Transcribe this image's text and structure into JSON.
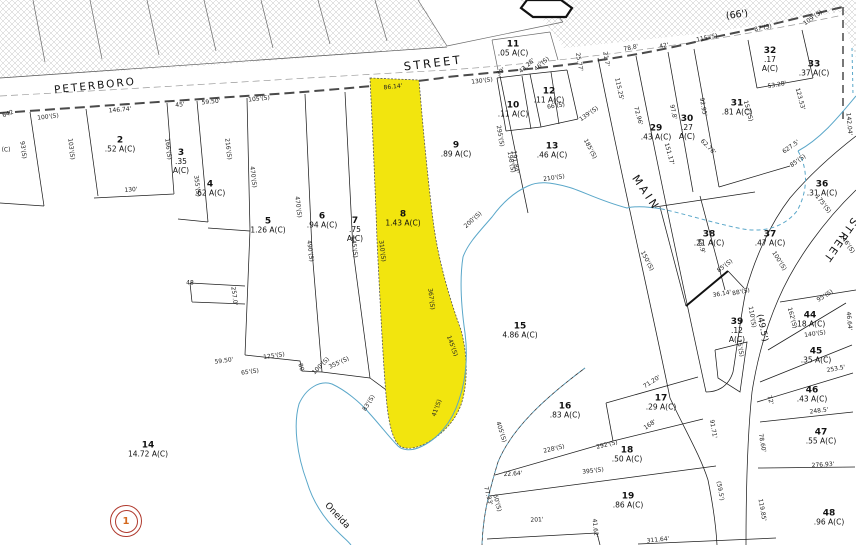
{
  "streets": {
    "peterboro": "PETERBORO",
    "street": "STREET",
    "main": "MAIN",
    "street_right": "STREET",
    "oneida": "Oneida",
    "width_66": "(66')",
    "width_49_5": "(49.5')"
  },
  "marker": {
    "label": "1"
  },
  "colors": {
    "highlight": "#f2e50e",
    "creek": "#5aa7c9",
    "marker_ring": "#b03a2e",
    "marker_text": "#d4691e",
    "line": "#1f1f1f",
    "hatch": "#c4c4c4"
  },
  "parcels": [
    {
      "id": "2",
      "area": ".52 A(C)",
      "x": 120,
      "y": 145
    },
    {
      "id": "3",
      "area": ".35 A(C)",
      "x": 181,
      "y": 162,
      "stack": true
    },
    {
      "id": "4",
      "area": ".62 A(C)",
      "x": 210,
      "y": 189
    },
    {
      "id": "5",
      "area": "1.26 A(C)",
      "x": 268,
      "y": 226
    },
    {
      "id": "6",
      "area": ".94 A(C)",
      "x": 322,
      "y": 221
    },
    {
      "id": "7",
      "area": ".75 A(C)",
      "x": 355,
      "y": 230,
      "stack": true
    },
    {
      "id": "8",
      "area": "1.43 A(C)",
      "x": 403,
      "y": 219
    },
    {
      "id": "9",
      "area": ".89 A(C)",
      "x": 456,
      "y": 150
    },
    {
      "id": "10",
      "area": ".11 A(C)",
      "x": 513,
      "y": 110
    },
    {
      "id": "11",
      "area": ".05 A(C)",
      "x": 513,
      "y": 49
    },
    {
      "id": "12",
      "area": ".11 A(C)",
      "x": 549,
      "y": 96
    },
    {
      "id": "13",
      "area": ".46 A(C)",
      "x": 552,
      "y": 151
    },
    {
      "id": "14",
      "area": "14.72 A(C)",
      "x": 148,
      "y": 450
    },
    {
      "id": "15",
      "area": "4.86 A(C)",
      "x": 520,
      "y": 331
    },
    {
      "id": "16",
      "area": ".83 A(C)",
      "x": 565,
      "y": 411
    },
    {
      "id": "17",
      "area": ".29 A(C)",
      "x": 661,
      "y": 403
    },
    {
      "id": "18",
      "area": ".50 A(C)",
      "x": 627,
      "y": 455
    },
    {
      "id": "19",
      "area": ".86 A(C)",
      "x": 628,
      "y": 501
    },
    {
      "id": "29",
      "area": ".43 A(C)",
      "x": 656,
      "y": 133
    },
    {
      "id": "30",
      "area": ".27 A(C)",
      "x": 687,
      "y": 128,
      "stack": true
    },
    {
      "id": "31",
      "area": ".81 A(C)",
      "x": 737,
      "y": 108
    },
    {
      "id": "32",
      "area": ".17 A(C)",
      "x": 770,
      "y": 60,
      "stack": true
    },
    {
      "id": "33",
      "area": ".37 A(C)",
      "x": 814,
      "y": 69
    },
    {
      "id": "36",
      "area": ".31 A(C)",
      "x": 822,
      "y": 189
    },
    {
      "id": "37",
      "area": ".47 A(C)",
      "x": 770,
      "y": 239
    },
    {
      "id": "38",
      "area": ".21 A(C)",
      "x": 709,
      "y": 239
    },
    {
      "id": "39",
      "area": ".12 A(C)",
      "x": 737,
      "y": 331,
      "stack": true
    },
    {
      "id": "44",
      "area": ".18 A(C)",
      "x": 810,
      "y": 320
    },
    {
      "id": "45",
      "area": ".35 A(C)",
      "x": 816,
      "y": 356
    },
    {
      "id": "46",
      "area": ".43 A(C)",
      "x": 812,
      "y": 395
    },
    {
      "id": "47",
      "area": ".55 A(C)",
      "x": 821,
      "y": 437
    },
    {
      "id": "48",
      "area": ".96 A(C)",
      "x": 829,
      "y": 518
    }
  ],
  "dimensions": [
    {
      "t": "642",
      "x": 8,
      "y": 114,
      "r": -20
    },
    {
      "t": "(C)",
      "x": 6,
      "y": 150,
      "r": 0
    },
    {
      "t": "100'(S)",
      "x": 48,
      "y": 117,
      "r": -7
    },
    {
      "t": "146.74'",
      "x": 120,
      "y": 110,
      "r": -5
    },
    {
      "t": "93'(S)",
      "x": 23,
      "y": 150,
      "r": 83
    },
    {
      "t": "103'(S)",
      "x": 71,
      "y": 149,
      "r": 83
    },
    {
      "t": "166'(S)",
      "x": 168,
      "y": 149,
      "r": 83
    },
    {
      "t": "130'",
      "x": 131,
      "y": 190,
      "r": -4
    },
    {
      "t": "45'",
      "x": 180,
      "y": 105,
      "r": -6
    },
    {
      "t": "59.50'",
      "x": 211,
      "y": 102,
      "r": -6
    },
    {
      "t": "105'(S)",
      "x": 259,
      "y": 99,
      "r": -6
    },
    {
      "t": "355'(S)",
      "x": 197,
      "y": 186,
      "r": 83
    },
    {
      "t": "216'(S)",
      "x": 228,
      "y": 149,
      "r": 83
    },
    {
      "t": "470'(S)",
      "x": 253,
      "y": 177,
      "r": 83
    },
    {
      "t": "470'(S)",
      "x": 298,
      "y": 207,
      "r": 83
    },
    {
      "t": "48",
      "x": 190,
      "y": 283,
      "r": 0
    },
    {
      "t": "257.0'",
      "x": 234,
      "y": 296,
      "r": 83
    },
    {
      "t": "59.50'",
      "x": 224,
      "y": 361,
      "r": -8
    },
    {
      "t": "125'(S)",
      "x": 274,
      "y": 356,
      "r": -8
    },
    {
      "t": "65'(S)",
      "x": 250,
      "y": 372,
      "r": -8
    },
    {
      "t": "80'",
      "x": 301,
      "y": 368,
      "r": 75
    },
    {
      "t": "100'(S)",
      "x": 321,
      "y": 366,
      "r": -45
    },
    {
      "t": "355'(S)",
      "x": 339,
      "y": 363,
      "r": -25
    },
    {
      "t": "490'(S)",
      "x": 310,
      "y": 251,
      "r": 83
    },
    {
      "t": "545'(S)",
      "x": 354,
      "y": 247,
      "r": 83
    },
    {
      "t": "86.14'",
      "x": 393,
      "y": 87,
      "r": -6
    },
    {
      "t": "310'(S)",
      "x": 382,
      "y": 251,
      "r": 83
    },
    {
      "t": "367'(S)",
      "x": 431,
      "y": 299,
      "r": 83
    },
    {
      "t": "145'(S)",
      "x": 452,
      "y": 346,
      "r": 70
    },
    {
      "t": "83'(S)",
      "x": 369,
      "y": 403,
      "r": -58
    },
    {
      "t": "41'(S)",
      "x": 437,
      "y": 408,
      "r": -70
    },
    {
      "t": "130'(S)",
      "x": 482,
      "y": 81,
      "r": -7
    },
    {
      "t": "39'",
      "x": 501,
      "y": 72,
      "r": -42
    },
    {
      "t": "43.28'",
      "x": 527,
      "y": 66,
      "r": -42
    },
    {
      "t": "46'(S)",
      "x": 542,
      "y": 64,
      "r": -42
    },
    {
      "t": "66'(S)",
      "x": 556,
      "y": 106,
      "r": -8
    },
    {
      "t": "295'(S)",
      "x": 500,
      "y": 136,
      "r": 80
    },
    {
      "t": "198'(S)",
      "x": 511,
      "y": 162,
      "r": 80
    },
    {
      "t": "139'(S)",
      "x": 589,
      "y": 114,
      "r": -35
    },
    {
      "t": "25.77'",
      "x": 579,
      "y": 62,
      "r": 80
    },
    {
      "t": "78.8'",
      "x": 631,
      "y": 48,
      "r": -12
    },
    {
      "t": "42'",
      "x": 664,
      "y": 46,
      "r": -12
    },
    {
      "t": "115'(S)",
      "x": 707,
      "y": 38,
      "r": -12
    },
    {
      "t": "87'(S)",
      "x": 763,
      "y": 28,
      "r": -12
    },
    {
      "t": "109'(S)",
      "x": 813,
      "y": 18,
      "r": -35
    },
    {
      "t": "210'(S)",
      "x": 554,
      "y": 178,
      "r": -8
    },
    {
      "t": "200'(S)",
      "x": 473,
      "y": 220,
      "r": -42
    },
    {
      "t": "191.84'",
      "x": 515,
      "y": 162,
      "r": 83
    },
    {
      "t": "185'(S)",
      "x": 590,
      "y": 149,
      "r": 62
    },
    {
      "t": "150'(S)",
      "x": 647,
      "y": 261,
      "r": 62
    },
    {
      "t": "21.7'",
      "x": 606,
      "y": 59,
      "r": 80
    },
    {
      "t": "115.25'",
      "x": 619,
      "y": 89,
      "r": 78
    },
    {
      "t": "72.96'",
      "x": 638,
      "y": 116,
      "r": 75
    },
    {
      "t": "97.8'",
      "x": 673,
      "y": 112,
      "r": 78
    },
    {
      "t": "151.17'",
      "x": 669,
      "y": 154,
      "r": 75
    },
    {
      "t": "92.95'",
      "x": 703,
      "y": 107,
      "r": 80
    },
    {
      "t": "157'(S)",
      "x": 748,
      "y": 111,
      "r": 75
    },
    {
      "t": "53.28'",
      "x": 777,
      "y": 85,
      "r": -10
    },
    {
      "t": "62.76'",
      "x": 708,
      "y": 147,
      "r": 45
    },
    {
      "t": "142.04'",
      "x": 849,
      "y": 124,
      "r": 85
    },
    {
      "t": "123.53'",
      "x": 800,
      "y": 99,
      "r": 75
    },
    {
      "t": "627.5'",
      "x": 791,
      "y": 147,
      "r": -35
    },
    {
      "t": "85'(S)",
      "x": 798,
      "y": 161,
      "r": -35
    },
    {
      "t": "175'(S)",
      "x": 823,
      "y": 204,
      "r": 52
    },
    {
      "t": "246'(S)",
      "x": 847,
      "y": 244,
      "r": 55
    },
    {
      "t": "66.9'",
      "x": 701,
      "y": 246,
      "r": 75
    },
    {
      "t": "85'(S)",
      "x": 725,
      "y": 266,
      "r": -38
    },
    {
      "t": "36.14'",
      "x": 722,
      "y": 294,
      "r": -10
    },
    {
      "t": "88'(S)",
      "x": 741,
      "y": 292,
      "r": -12
    },
    {
      "t": "100'(S)",
      "x": 779,
      "y": 261,
      "r": 58
    },
    {
      "t": "95'(S)",
      "x": 825,
      "y": 296,
      "r": -32
    },
    {
      "t": "110'(S)",
      "x": 752,
      "y": 317,
      "r": 80
    },
    {
      "t": "162'(S)",
      "x": 792,
      "y": 318,
      "r": 75
    },
    {
      "t": "46.64'",
      "x": 849,
      "y": 321,
      "r": 85
    },
    {
      "t": "140'(S)",
      "x": 815,
      "y": 334,
      "r": -8
    },
    {
      "t": "15'(S)",
      "x": 740,
      "y": 348,
      "r": 80
    },
    {
      "t": "253.5'",
      "x": 836,
      "y": 369,
      "r": -10
    },
    {
      "t": "71.20'",
      "x": 652,
      "y": 382,
      "r": -33
    },
    {
      "t": "168'",
      "x": 650,
      "y": 425,
      "r": -33
    },
    {
      "t": "228'(S)",
      "x": 554,
      "y": 449,
      "r": -13
    },
    {
      "t": "292'(S)",
      "x": 607,
      "y": 445,
      "r": -13
    },
    {
      "t": "91.71'",
      "x": 713,
      "y": 429,
      "r": 80
    },
    {
      "t": "395'(S)",
      "x": 593,
      "y": 471,
      "r": -7
    },
    {
      "t": "22.64'",
      "x": 513,
      "y": 474,
      "r": -4
    },
    {
      "t": "405'(S)",
      "x": 501,
      "y": 432,
      "r": 72
    },
    {
      "t": "77.33'",
      "x": 488,
      "y": 496,
      "r": 75
    },
    {
      "t": "60'(S)",
      "x": 497,
      "y": 503,
      "r": 75
    },
    {
      "t": "201'",
      "x": 537,
      "y": 520,
      "r": -3
    },
    {
      "t": "41.62'",
      "x": 595,
      "y": 528,
      "r": 85
    },
    {
      "t": "311.64'",
      "x": 658,
      "y": 540,
      "r": -6
    },
    {
      "t": "(59.5')",
      "x": 720,
      "y": 491,
      "r": 80
    },
    {
      "t": "72'",
      "x": 770,
      "y": 400,
      "r": 75
    },
    {
      "t": "248.5'",
      "x": 819,
      "y": 411,
      "r": -7
    },
    {
      "t": "78.60'",
      "x": 762,
      "y": 443,
      "r": 80
    },
    {
      "t": "276.93'",
      "x": 823,
      "y": 465,
      "r": -4
    },
    {
      "t": "119.85'",
      "x": 762,
      "y": 510,
      "r": 80
    }
  ]
}
